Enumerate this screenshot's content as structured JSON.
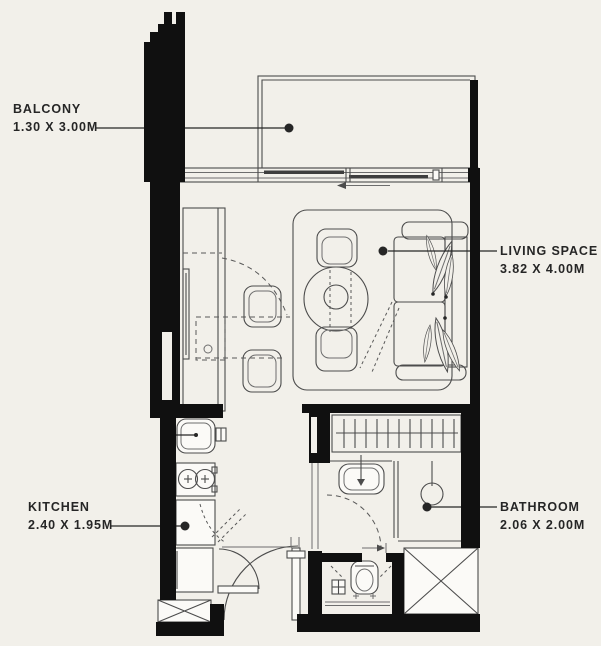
{
  "rooms": {
    "balcony": {
      "name": "BALCONY",
      "dims": "1.30 X 3.00M"
    },
    "living": {
      "name": "LIVING SPACE",
      "dims": "3.82 X 4.00M"
    },
    "kitchen": {
      "name": "KITCHEN",
      "dims": "2.40 X 1.95M"
    },
    "bathroom": {
      "name": "BATHROOM",
      "dims": "2.06 X 2.00M"
    }
  },
  "colors": {
    "background": "#f2f0ea",
    "walls": "#101010",
    "lines": "#4c4c4c",
    "text": "#262626"
  }
}
